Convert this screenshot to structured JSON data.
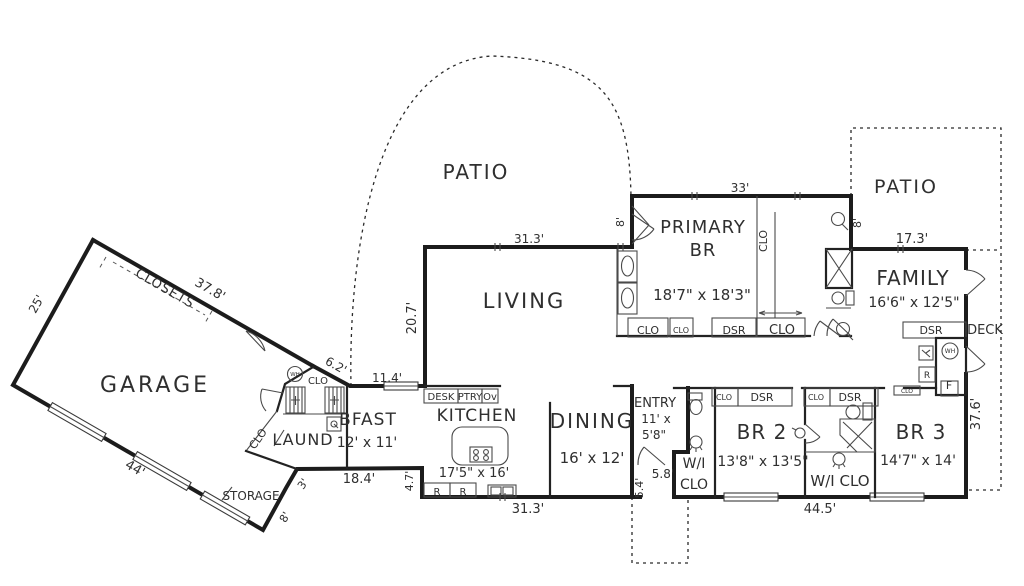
{
  "canvas": {
    "background": "#ffffff",
    "wall_color": "#1c1c1c",
    "text_color": "#2f2f2f"
  },
  "plan": {
    "labels": [
      {
        "id": "garage-room",
        "text": "GARAGE",
        "x": 155,
        "y": 392,
        "size": 22,
        "ls": 3
      },
      {
        "id": "patio-top-room",
        "text": "PATIO",
        "x": 476,
        "y": 179,
        "size": 20,
        "ls": 2
      },
      {
        "id": "patio-right-room",
        "text": "PATIO",
        "x": 906,
        "y": 193,
        "size": 19,
        "ls": 2
      },
      {
        "id": "living-room",
        "text": "LIVING",
        "x": 524,
        "y": 308,
        "size": 21,
        "ls": 2
      },
      {
        "id": "primary-br-line1",
        "text": "PRIMARY",
        "x": 703,
        "y": 233,
        "size": 18,
        "ls": 1
      },
      {
        "id": "primary-br-line2",
        "text": "BR",
        "x": 703,
        "y": 256,
        "size": 18,
        "ls": 1
      },
      {
        "id": "primary-br-dims",
        "text": "18'7\" x 18'3\"",
        "x": 702,
        "y": 300,
        "size": 15
      },
      {
        "id": "family-room",
        "text": "FAMILY",
        "x": 913,
        "y": 285,
        "size": 20,
        "ls": 1
      },
      {
        "id": "family-dims",
        "text": "16'6\" x 12'5\"",
        "x": 914,
        "y": 307,
        "size": 14
      },
      {
        "id": "kitchen-room",
        "text": "KITCHEN",
        "x": 477,
        "y": 421,
        "size": 17,
        "ls": 1
      },
      {
        "id": "kitchen-dims",
        "text": "17'5\" x 16'",
        "x": 474,
        "y": 477,
        "size": 13
      },
      {
        "id": "bfast-room",
        "text": "BFAST",
        "x": 368,
        "y": 425,
        "size": 17,
        "ls": 1
      },
      {
        "id": "bfast-dims",
        "text": "12' x 11'",
        "x": 367,
        "y": 447,
        "size": 14
      },
      {
        "id": "dining-room",
        "text": "DINING",
        "x": 592,
        "y": 428,
        "size": 20,
        "ls": 2
      },
      {
        "id": "dining-dims",
        "text": "16' x 12'",
        "x": 592,
        "y": 463,
        "size": 15
      },
      {
        "id": "entry-room",
        "text": "ENTRY",
        "x": 655,
        "y": 407,
        "size": 13
      },
      {
        "id": "entry-dims-1",
        "text": "11' x",
        "x": 656,
        "y": 423,
        "size": 12
      },
      {
        "id": "entry-dims-2",
        "text": "5'8\"",
        "x": 654,
        "y": 439,
        "size": 12
      },
      {
        "id": "br2-room",
        "text": "BR 2",
        "x": 762,
        "y": 439,
        "size": 20,
        "ls": 1
      },
      {
        "id": "br2-dims",
        "text": "13'8\" x 13'5\"",
        "x": 763,
        "y": 466,
        "size": 14
      },
      {
        "id": "br3-room",
        "text": "BR 3",
        "x": 921,
        "y": 439,
        "size": 20,
        "ls": 1
      },
      {
        "id": "br3-dims",
        "text": "14'7\" x 14'",
        "x": 918,
        "y": 465,
        "size": 14
      },
      {
        "id": "laundry-room",
        "text": "LAUND",
        "x": 303,
        "y": 445,
        "size": 16,
        "ls": 1
      },
      {
        "id": "storage-room",
        "text": "STORAGE",
        "x": 251,
        "y": 500,
        "size": 12
      },
      {
        "id": "deck-area",
        "text": "DECK",
        "x": 985,
        "y": 334,
        "size": 13
      },
      {
        "id": "wi-clo-entry-1",
        "text": "W/I",
        "x": 694,
        "y": 468,
        "size": 14
      },
      {
        "id": "wi-clo-entry-2",
        "text": "CLO",
        "x": 694,
        "y": 489,
        "size": 14
      },
      {
        "id": "wi-clo-br3",
        "text": "W/I CLO",
        "x": 840,
        "y": 486,
        "size": 15
      },
      {
        "id": "closets",
        "text": "CLOSETS",
        "x": 163,
        "y": 292,
        "size": 13,
        "rot": 30,
        "ls": 1
      },
      {
        "id": "dim-25",
        "text": "25'",
        "x": 40,
        "y": 306,
        "size": 12,
        "rot": -61
      },
      {
        "id": "dim-37-8",
        "text": "37.8'",
        "x": 208,
        "y": 293,
        "size": 13,
        "rot": 30
      },
      {
        "id": "dim-44",
        "text": "44'",
        "x": 133,
        "y": 472,
        "size": 13,
        "rot": 30
      },
      {
        "id": "dim-8-garage",
        "text": "8'",
        "x": 288,
        "y": 519,
        "size": 11,
        "rot": -60
      },
      {
        "id": "dim-3",
        "text": "3'",
        "x": 306,
        "y": 486,
        "size": 11,
        "rot": -55
      },
      {
        "id": "dim-6-2",
        "text": "6.2'",
        "x": 334,
        "y": 369,
        "size": 12,
        "rot": 29
      },
      {
        "id": "dim-11-4",
        "text": "11.4'",
        "x": 387,
        "y": 382,
        "size": 12
      },
      {
        "id": "dim-18-4",
        "text": "18.4'",
        "x": 359,
        "y": 483,
        "size": 13
      },
      {
        "id": "dim-4-7",
        "text": "4.7'",
        "x": 413,
        "y": 481,
        "size": 11,
        "rot": -90
      },
      {
        "id": "dim-31-3-bottom",
        "text": "31.3'",
        "x": 528,
        "y": 513,
        "size": 13
      },
      {
        "id": "dim-31-3-top",
        "text": "31.3'",
        "x": 529,
        "y": 243,
        "size": 12
      },
      {
        "id": "dim-20-7",
        "text": "20.7'",
        "x": 416,
        "y": 318,
        "size": 13,
        "rot": -90
      },
      {
        "id": "dim-5-4",
        "text": "5.4'",
        "x": 643,
        "y": 488,
        "size": 11,
        "rot": -90
      },
      {
        "id": "dim-5-8",
        "text": "5.8'",
        "x": 663,
        "y": 478,
        "size": 12
      },
      {
        "id": "dim-33",
        "text": "33'",
        "x": 740,
        "y": 192,
        "size": 12
      },
      {
        "id": "dim-8-primary-left",
        "text": "8'",
        "x": 624,
        "y": 222,
        "size": 11,
        "rot": -90
      },
      {
        "id": "dim-8-primary-right",
        "text": "8'",
        "x": 861,
        "y": 223,
        "size": 11,
        "rot": -90
      },
      {
        "id": "dim-17-3",
        "text": "17.3'",
        "x": 912,
        "y": 243,
        "size": 13
      },
      {
        "id": "dim-44-5",
        "text": "44.5'",
        "x": 820,
        "y": 513,
        "size": 13
      },
      {
        "id": "dim-37-6",
        "text": "37.6'",
        "x": 980,
        "y": 414,
        "size": 13,
        "rot": -90
      },
      {
        "id": "desk-cabinet",
        "text": "DESK",
        "x": 441,
        "y": 400,
        "size": 10
      },
      {
        "id": "pantry-cabinet",
        "text": "PTRY",
        "x": 470,
        "y": 400,
        "size": 10
      },
      {
        "id": "oven-cabinet",
        "text": "Ov",
        "x": 490,
        "y": 400,
        "size": 10
      },
      {
        "id": "fridge-1",
        "text": "R",
        "x": 437,
        "y": 495,
        "size": 10
      },
      {
        "id": "fridge-2",
        "text": "R",
        "x": 463,
        "y": 495,
        "size": 10
      },
      {
        "id": "clo-garage-nook",
        "text": "CLO",
        "x": 318,
        "y": 384,
        "size": 10
      },
      {
        "id": "clo-laundry",
        "text": "CLO",
        "x": 261,
        "y": 441,
        "size": 11,
        "rot": -55
      },
      {
        "id": "clo-primary-1",
        "text": "CLO",
        "x": 648,
        "y": 334,
        "size": 11
      },
      {
        "id": "clo-primary-2",
        "text": "CLO",
        "x": 681,
        "y": 333,
        "size": 8
      },
      {
        "id": "dsr-primary",
        "text": "DSR",
        "x": 734,
        "y": 334,
        "size": 11
      },
      {
        "id": "clo-primary-3",
        "text": "CLO",
        "x": 782,
        "y": 334,
        "size": 13
      },
      {
        "id": "clo-primary-vertical",
        "text": "CLO",
        "x": 767,
        "y": 241,
        "size": 11,
        "rot": -90
      },
      {
        "id": "dsr-family",
        "text": "DSR",
        "x": 931,
        "y": 334,
        "size": 11
      },
      {
        "id": "clo-br2",
        "text": "CLO",
        "x": 724,
        "y": 400,
        "size": 8
      },
      {
        "id": "dsr-br2",
        "text": "DSR",
        "x": 762,
        "y": 401,
        "size": 11
      },
      {
        "id": "clo-br3",
        "text": "CLO",
        "x": 816,
        "y": 400,
        "size": 8
      },
      {
        "id": "dsr-br3",
        "text": "DSR",
        "x": 850,
        "y": 401,
        "size": 11
      },
      {
        "id": "furnace",
        "text": "F",
        "x": 949,
        "y": 389,
        "size": 11
      },
      {
        "id": "fridge-3",
        "text": "R",
        "x": 927,
        "y": 378,
        "size": 9
      },
      {
        "id": "water-heater-family",
        "text": "WH",
        "x": 950,
        "y": 353,
        "size": 6
      },
      {
        "id": "water-heater-garage",
        "text": "WH",
        "x": 295,
        "y": 376,
        "size": 5.5
      },
      {
        "id": "clo-family-tiny",
        "text": "CLO",
        "x": 907,
        "y": 393,
        "size": 6
      }
    ]
  }
}
